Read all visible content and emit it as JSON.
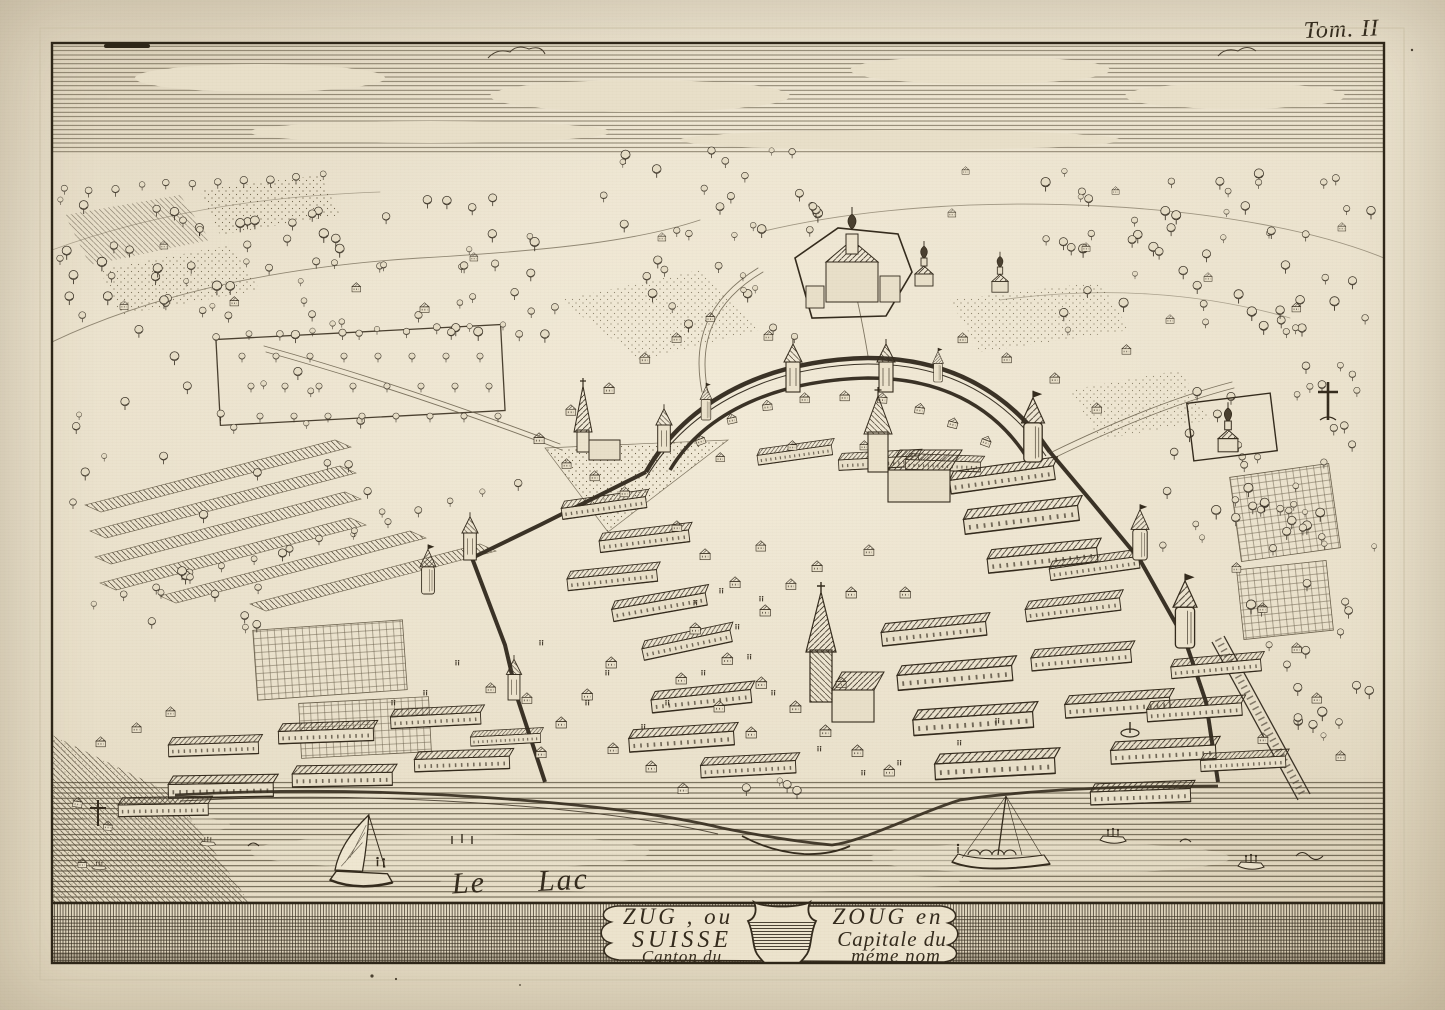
{
  "plate": {
    "tome_label": "Tom. II",
    "lake_label": {
      "word1": "Le",
      "word2": "Lac"
    },
    "cartouche": {
      "left": [
        "ZUG , ou",
        "SUISSE",
        "Canton du"
      ],
      "right": [
        "ZOUG en",
        "Capitale du",
        "méme nom"
      ]
    },
    "colors": {
      "paper": "#e8dfc9",
      "ink": "#342b1d"
    }
  }
}
